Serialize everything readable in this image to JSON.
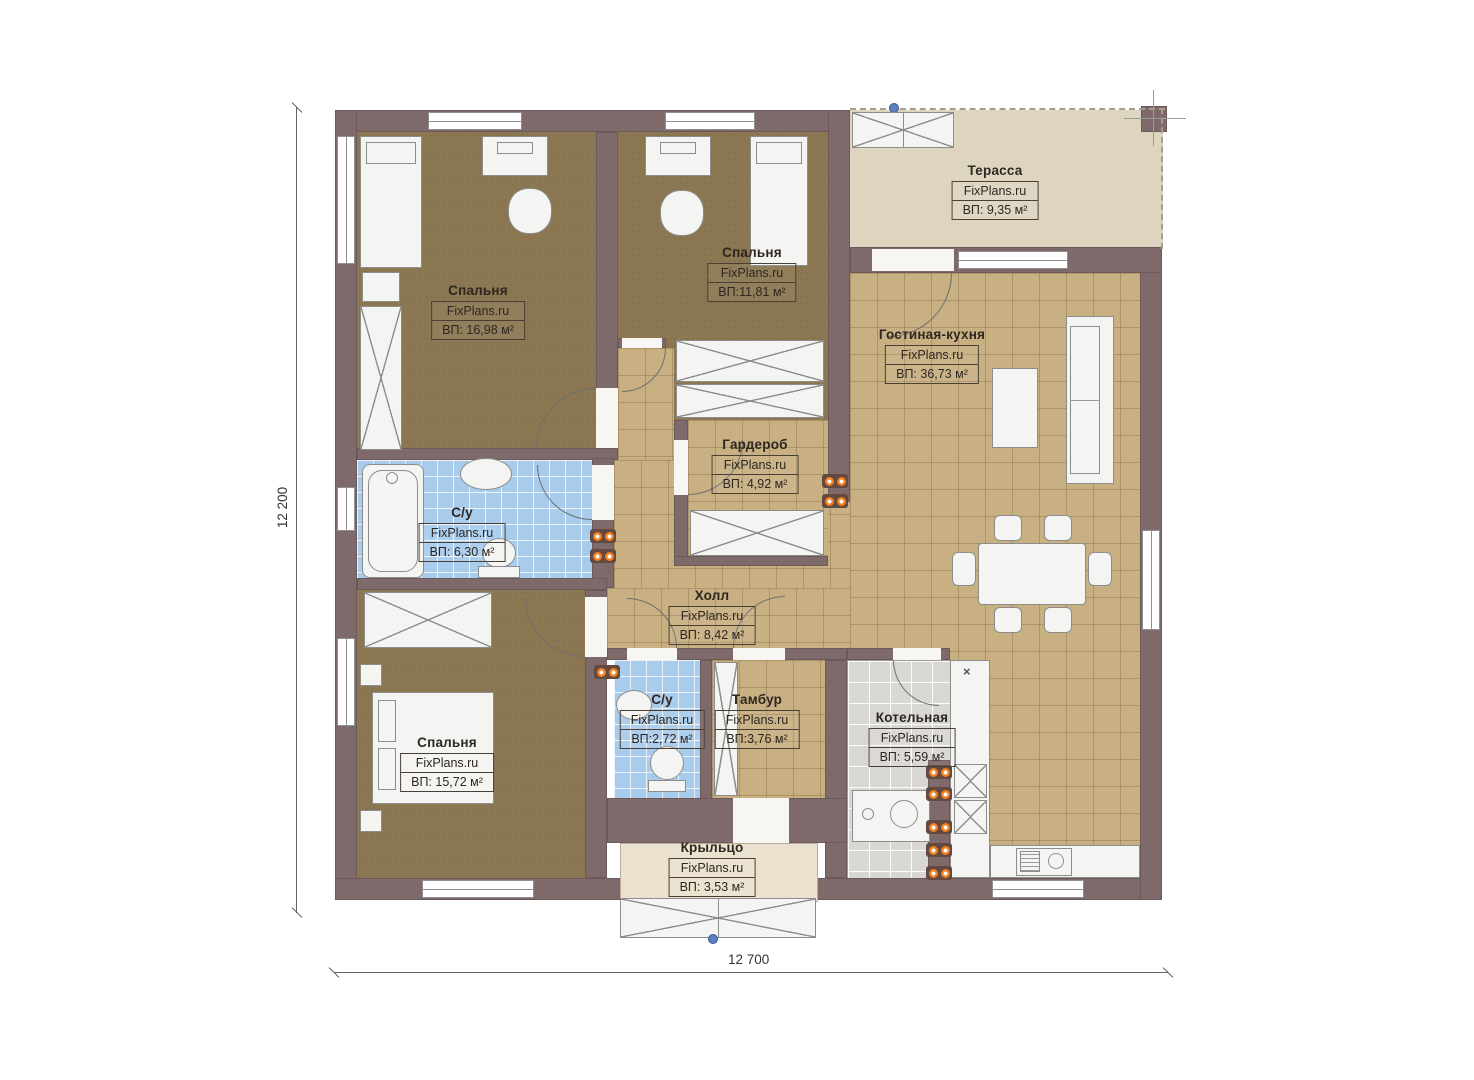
{
  "brand": "FixPlans.ru",
  "dimensions": {
    "width_label": "12 700",
    "height_label": "12 200"
  },
  "symbols": {
    "kitchen_marker": "×"
  },
  "rooms": [
    {
      "name": "Спальня",
      "brand": "FixPlans.ru",
      "area": "ВП: 16,98 м²"
    },
    {
      "name": "Спальня",
      "brand": "FixPlans.ru",
      "area": "ВП:11,81 м²"
    },
    {
      "name": "Терасса",
      "brand": "FixPlans.ru",
      "area": "ВП: 9,35 м²"
    },
    {
      "name": "Гостиная-кухня",
      "brand": "FixPlans.ru",
      "area": "ВП: 36,73 м²"
    },
    {
      "name": "Гардероб",
      "brand": "FixPlans.ru",
      "area": "ВП: 4,92 м²"
    },
    {
      "name": "С/у",
      "brand": "FixPlans.ru",
      "area": "ВП: 6,30 м²"
    },
    {
      "name": "Холл",
      "brand": "FixPlans.ru",
      "area": "ВП: 8,42 м²"
    },
    {
      "name": "Спальня",
      "brand": "FixPlans.ru",
      "area": "ВП: 15,72 м²"
    },
    {
      "name": "С/у",
      "brand": "FixPlans.ru",
      "area": "ВП:2,72 м²"
    },
    {
      "name": "Тамбур",
      "brand": "FixPlans.ru",
      "area": "ВП:3,76 м²"
    },
    {
      "name": "Котельная",
      "brand": "FixPlans.ru",
      "area": "ВП: 5,59 м²"
    },
    {
      "name": "Крыльцо",
      "brand": "FixPlans.ru",
      "area": "ВП: 3,53 м²"
    }
  ],
  "colors": {
    "wall": "#7e6a6a",
    "bedroom_floor": "#8b7751",
    "tile_floor": "#c8b083",
    "bathroom_floor": "#a9cbec",
    "terrace_floor": "#ded5c1",
    "porch_floor": "#eae1ce",
    "boiler_floor": "#d8d7d4",
    "radiator": "#f58020",
    "marker_blue": "#5b7fbe"
  }
}
